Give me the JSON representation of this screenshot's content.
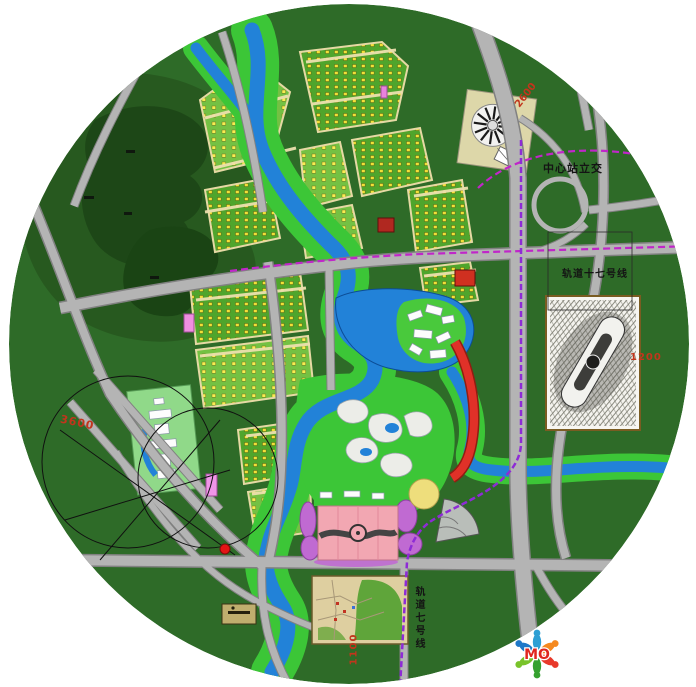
{
  "labels": {
    "interchange": "中心站立交",
    "rail_line_17": "轨道十七号线",
    "rail_line_7": "轨道七号线",
    "dim_west": "3600",
    "dim_east": "1200",
    "dim_south": "1100",
    "dim_northeast": "2600"
  },
  "logo": {
    "text": "MO",
    "figure_colors": [
      "#2e9fd4",
      "#f5891f",
      "#e8392b",
      "#35a12f",
      "#79c32a",
      "#1f78c8"
    ]
  },
  "colors": {
    "base_green": "#2e6b28",
    "forest_green": "#27591f",
    "park_green": "#3cc637",
    "river_blue": "#2282d8",
    "road_gray": "#b4b4b4",
    "rail_magenta": "#c026c9",
    "rail_purple": "#8e2bd6",
    "plaza_pink": "#f2a7b2",
    "dim_red": "#c2351c"
  }
}
